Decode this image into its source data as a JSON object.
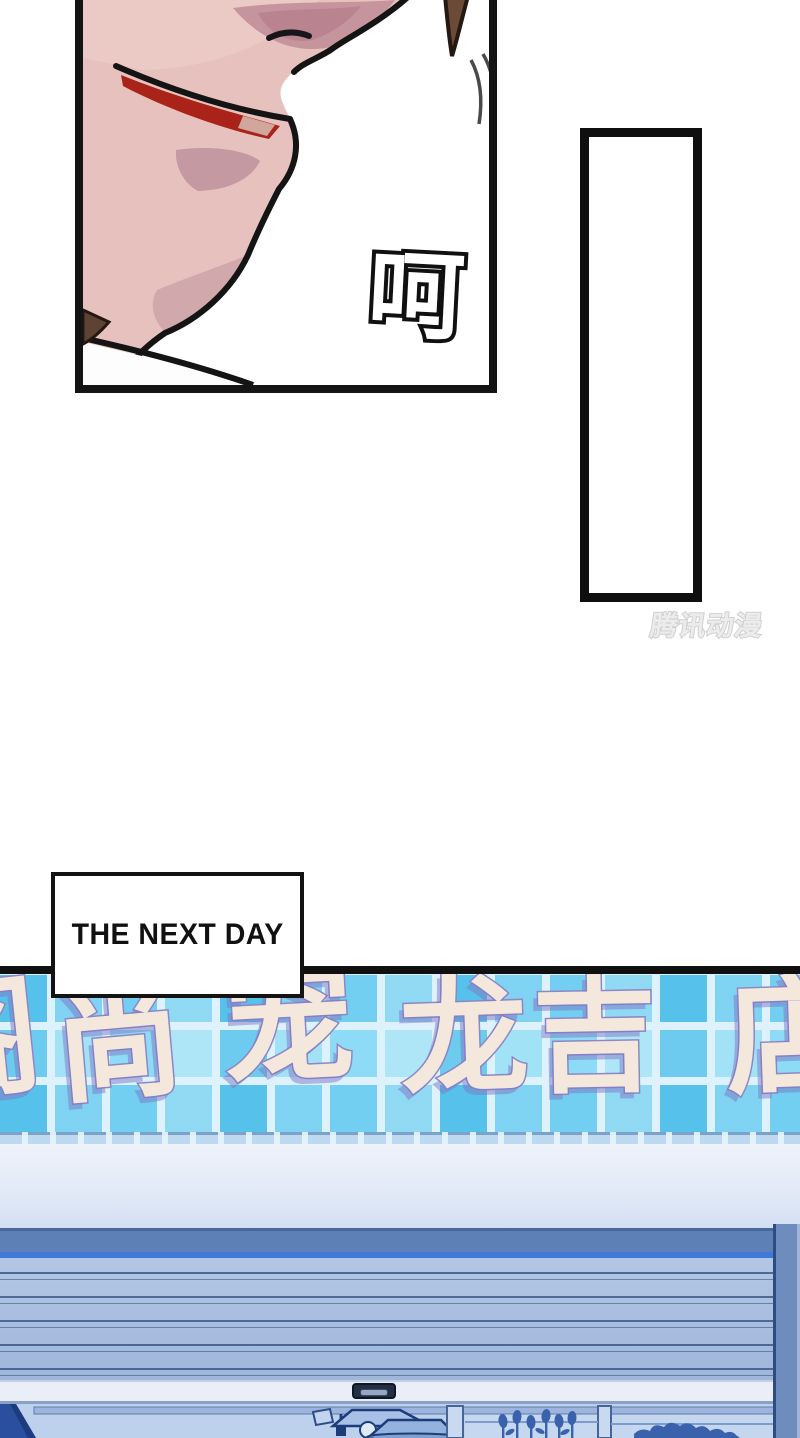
{
  "page": {
    "kind": "manga-page",
    "width_px": 800,
    "height_px": 1438,
    "background": "#ffffff"
  },
  "face_panel": {
    "sfx": "呵",
    "colors": {
      "skin": "#e6c1bd",
      "skin_highlight": "#eed2cd",
      "skin_shadow": "#c6949c",
      "deep_shadow": "#b5808c",
      "lip_red": "#a92319",
      "hair_brown": "#6b4a37",
      "outline": "#141414"
    }
  },
  "empty_panel": {
    "border_color": "#0f0f0f",
    "fill": "#ffffff"
  },
  "watermark": {
    "text": "腾讯动漫",
    "color": "#d0d0d0"
  },
  "caption": {
    "text": "THE NEXT DAY",
    "border_color": "#131313",
    "background": "#ffffff",
    "text_color": "#111111"
  },
  "storefront": {
    "sign_characters": [
      "阁",
      "尚",
      "宠",
      "龙",
      "吉",
      "店"
    ],
    "sign_colors": {
      "fill": "#f4e8dc",
      "outline": "#8d87c5",
      "shadow": "#7d78c3"
    },
    "tile_colors": {
      "base": "#8edcf6",
      "saturated": "#5ec4ea",
      "pale": "#c3ecfa",
      "grout": "#ddf2fc"
    },
    "shutter_colors": {
      "housing": "#5d80b6",
      "accent_line": "#3f7ad9",
      "slats": "#a9bedf",
      "slat_line": "#2d4d7d",
      "bottom_bar": "#e9eef7",
      "handle": "#232f45",
      "frame": "#6e8cbe"
    },
    "interior_colors": {
      "base": "#bdd0ec",
      "silhouette": "#3a61ab",
      "dark_drape": "#2a4f9e"
    }
  }
}
